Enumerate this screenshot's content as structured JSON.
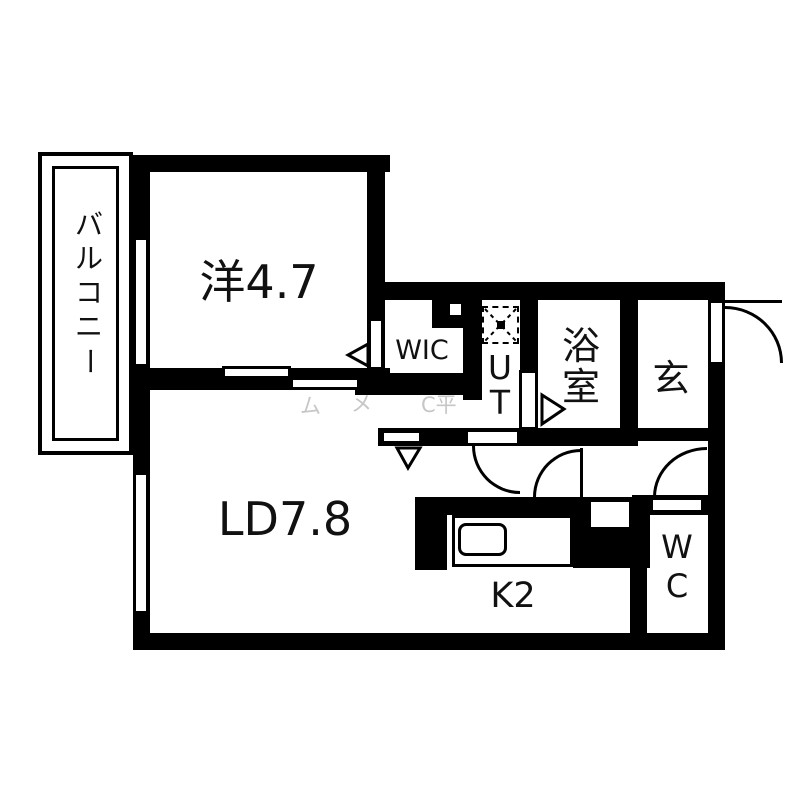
{
  "floorplan": {
    "rooms": {
      "bedroom": {
        "label": "洋4.7"
      },
      "living": {
        "label": "LD7.8"
      },
      "kitchen": {
        "label": "K2"
      },
      "wic": {
        "label": "WIC"
      },
      "entrance": {
        "label": "玄"
      },
      "balcony": {
        "chars": [
          "バ",
          "ル",
          "コ",
          "ニ",
          "ー"
        ]
      },
      "bath": {
        "chars": [
          "浴",
          "室"
        ]
      },
      "utility": {
        "chars": [
          "U",
          "T"
        ]
      },
      "toilet": {
        "chars": [
          "W",
          "C"
        ]
      }
    },
    "watermark": {
      "fragments": [
        "ム",
        "メ",
        "C平"
      ]
    },
    "colors": {
      "wall": "#000000",
      "background": "#ffffff",
      "watermark": "#c6c6c6"
    }
  }
}
